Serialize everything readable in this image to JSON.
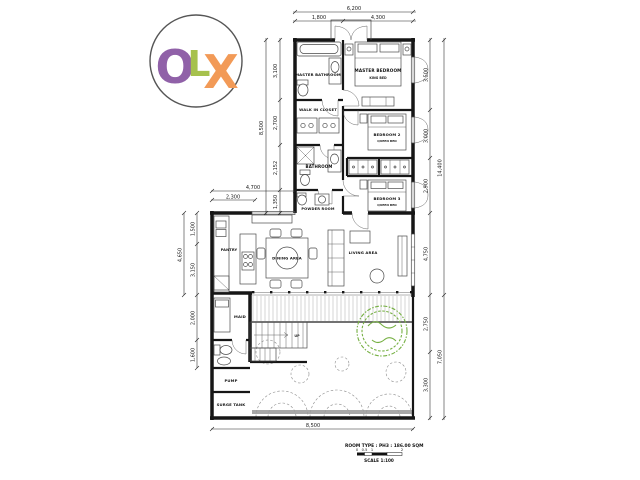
{
  "logo": {
    "o": "O",
    "l": "L",
    "x": "X",
    "o_color": "#9061a8",
    "l_color": "#a6c14d",
    "x_color": "#f29a57"
  },
  "colors": {
    "tree": "#76b043",
    "paving": "#999999"
  },
  "rooms": {
    "master_bathroom": "MASTER BATHROOM",
    "master_bedroom": "MASTER BEDROOM",
    "king_bed": "KING BED",
    "walk_in_closet": "WALK IN CLOSET",
    "bedroom_2": "BEDROOM 2",
    "bedroom_3": "BEDROOM 3",
    "queen_bed": "QUEEN BED",
    "bathroom": "BATHROOM",
    "powder_room": "POWDER ROOM",
    "pantry": "PANTRY",
    "dining_area": "DINING AREA",
    "living_area": "LIVING AREA",
    "maid": "MAID",
    "pump": "PUMP",
    "surge_tank": "SURGE TANK",
    "up": "UP"
  },
  "dims": {
    "top_overall": "6,200",
    "top_seg1": "1,800",
    "top_seg2": "4,300",
    "left_up_overall": "8,500",
    "left_up_seg1": "3,100",
    "left_up_seg2": "2,700",
    "left_up_seg3": "2,152",
    "left_up_seg4": "1,350",
    "mid_top": "4,700",
    "mid_top_inner": "2,300",
    "left_low_overall": "4,650",
    "left_low_seg1": "1,500",
    "left_low_seg2": "3,150",
    "left_low_seg3": "2,000",
    "left_low_seg4": "1,600",
    "right_up_overall": "14,400",
    "right_seg1": "3,500",
    "right_seg2": "3,000",
    "right_seg3": "2,900",
    "right_seg4": "4,750",
    "right_low_overall": "7,050",
    "right_seg5": "2,750",
    "right_seg6": "3,300",
    "bottom_overall": "8,500"
  },
  "legend": {
    "room_type": "ROOM TYPE : PH3 : 186.00 SQM",
    "scale": "SCALE 1:100",
    "t0": "0",
    "t05": "0.5",
    "t1": "1",
    "t2": "2"
  }
}
